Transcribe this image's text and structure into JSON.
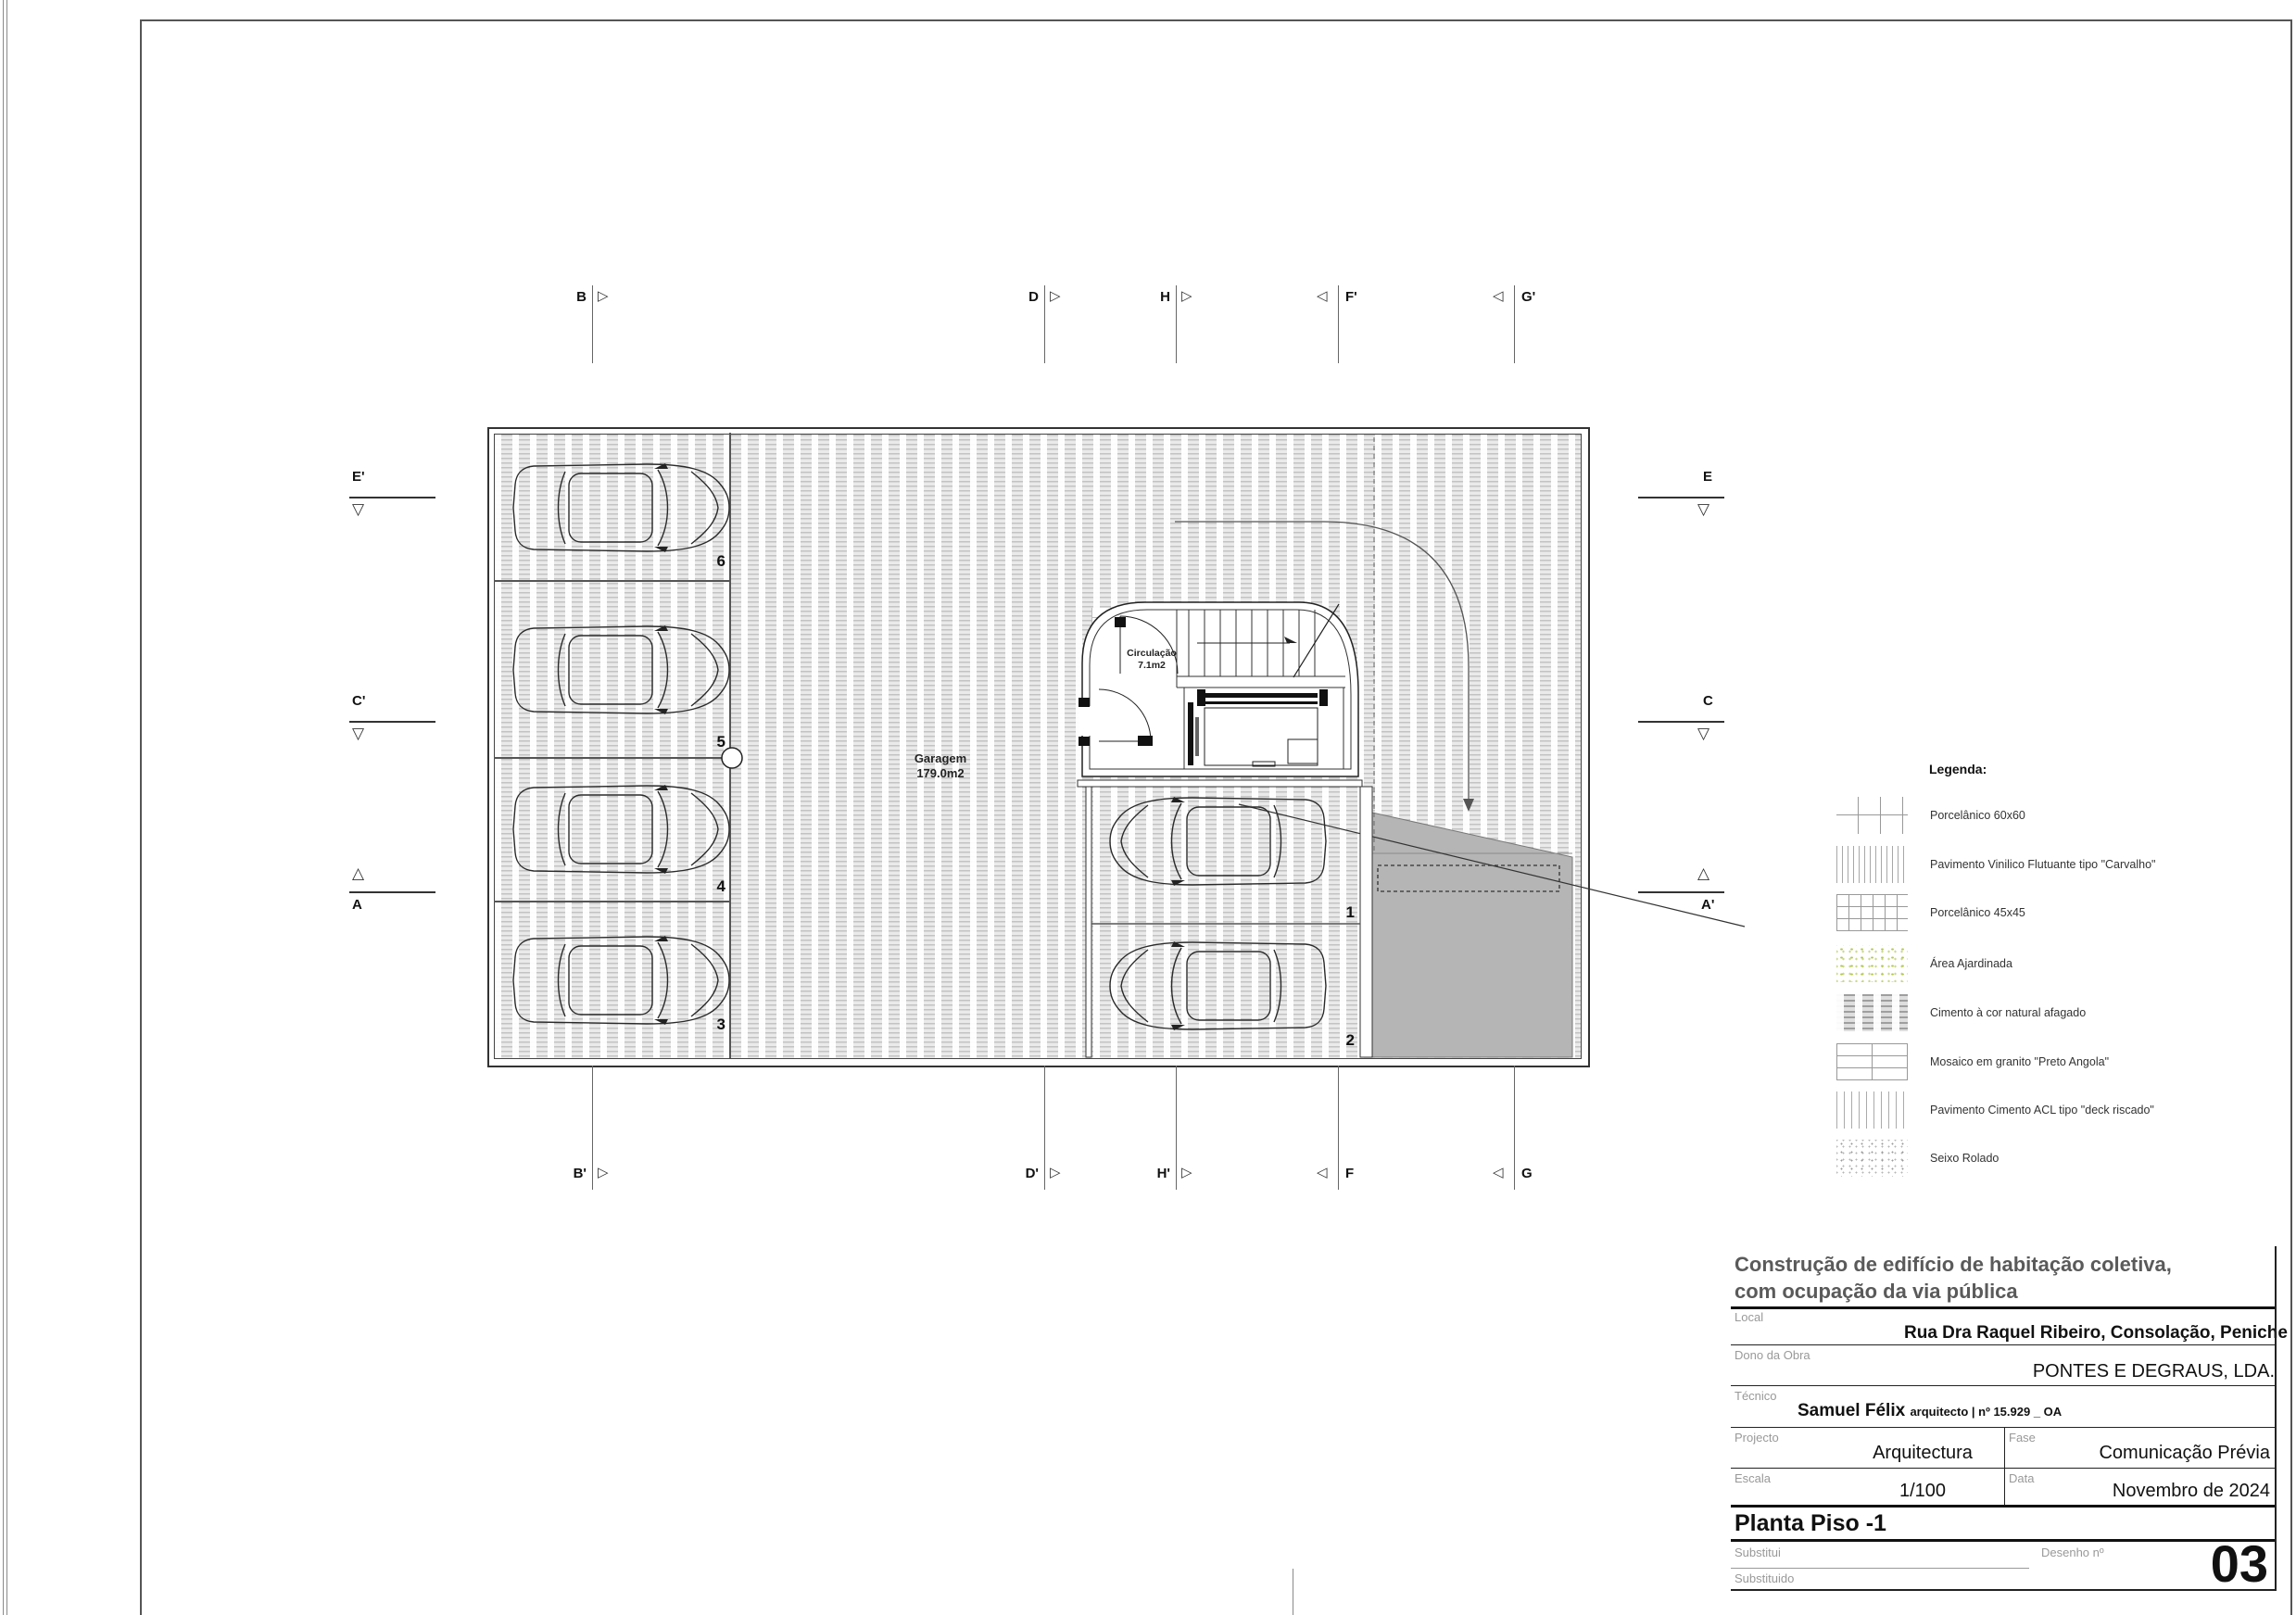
{
  "plan": {
    "garage_label": "Garagem",
    "garage_area": "179.0m2",
    "circulation_label": "Circulação",
    "circulation_area": "7.1m2",
    "spots": [
      "1",
      "2",
      "3",
      "4",
      "5",
      "6"
    ]
  },
  "markers": {
    "top": [
      "B",
      "D",
      "H",
      "F'",
      "G'"
    ],
    "bottom": [
      "B'",
      "D'",
      "H'",
      "F",
      "G"
    ],
    "left": [
      "E'",
      "C'",
      "A"
    ],
    "right": [
      "E",
      "C",
      "A'"
    ]
  },
  "icons": {
    "tri_right": "▷",
    "tri_left": "◁",
    "tri_down": "▽",
    "tri_up": "△"
  },
  "legend": {
    "title": "Legenda:",
    "items": [
      {
        "label": "Porcelânico 60x60",
        "pattern": "grid-sparse"
      },
      {
        "label": "Pavimento Vinilico Flutuante tipo \"Carvalho\"",
        "pattern": "vlines-dense"
      },
      {
        "label": "Porcelânico 45x45",
        "pattern": "grid-dense"
      },
      {
        "label": "Área Ajardinada",
        "pattern": "green-speckle"
      },
      {
        "label": "Cimento à cor natural afagado",
        "pattern": "cement-streaks"
      },
      {
        "label": "Mosaico em granito \"Preto Angola\"",
        "pattern": "brick"
      },
      {
        "label": "Pavimento Cimento ACL tipo \"deck riscado\"",
        "pattern": "vlines-sparse"
      },
      {
        "label": "Seixo Rolado",
        "pattern": "gray-speckle"
      }
    ]
  },
  "title_block": {
    "project_title_line1": "Construção de edifício de habitação coletiva,",
    "project_title_line2": "com ocupação da via pública",
    "local_label": "Local",
    "local_value": "Rua Dra Raquel Ribeiro, Consolação, Peniche",
    "owner_label": "Dono da Obra",
    "owner_value": "PONTES E DEGRAUS, LDA.",
    "technician_label": "Técnico",
    "technician_name": "Samuel Félix",
    "technician_title": "arquitecto | nº 15.929 _ OA",
    "project_label": "Projecto",
    "project_value": "Arquitectura",
    "phase_label": "Fase",
    "phase_value": "Comunicação Prévia",
    "scale_label": "Escala",
    "scale_value": "1/100",
    "date_label": "Data",
    "date_value": "Novembro de 2024",
    "drawing_name": "Planta Piso -1",
    "replaces_label": "Substitui",
    "replaced_label": "Substituido",
    "drawing_no_label": "Desenho nº",
    "drawing_no_value": "03"
  },
  "colors": {
    "ramp_gray": "#b5b5b5",
    "line_dark": "#222222"
  }
}
